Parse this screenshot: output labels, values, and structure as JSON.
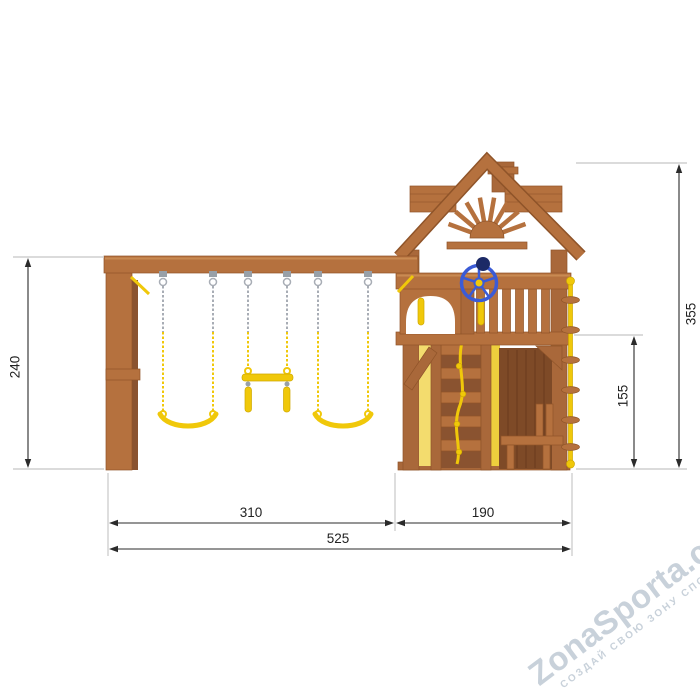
{
  "page": {
    "background": "#ffffff"
  },
  "colors": {
    "wood_main": "#b5713e",
    "wood_mid": "#a9683a",
    "wood_dark": "#8a5330",
    "wood_deep": "#7e4a27",
    "wood_edge": "#8f5429",
    "wood_light": "#c98a52",
    "accent_yellow": "#f0c80a",
    "accent_yellow_soft": "#f3dc6e",
    "accent_yellow_deep": "#eecf3d",
    "chain_gray": "#a8adb5",
    "wheel_blue": "#3b5bd6",
    "wheel_navy": "#1c2a66",
    "dim_line": "#2b2b2b",
    "dim_text": "#222222",
    "ext_line": "#cfcfcf",
    "watermark_text": "#c8d1da"
  },
  "dimensions": {
    "swing_frame_height": "240",
    "overall_height": "355",
    "deck_height": "155",
    "swing_section_width": "310",
    "tower_section_width": "190",
    "overall_width": "525"
  },
  "watermark": {
    "brand": "ZonaSporta.com",
    "tagline": "СОЗДАЙ СВОЮ ЗОНУ СПОРТА"
  }
}
